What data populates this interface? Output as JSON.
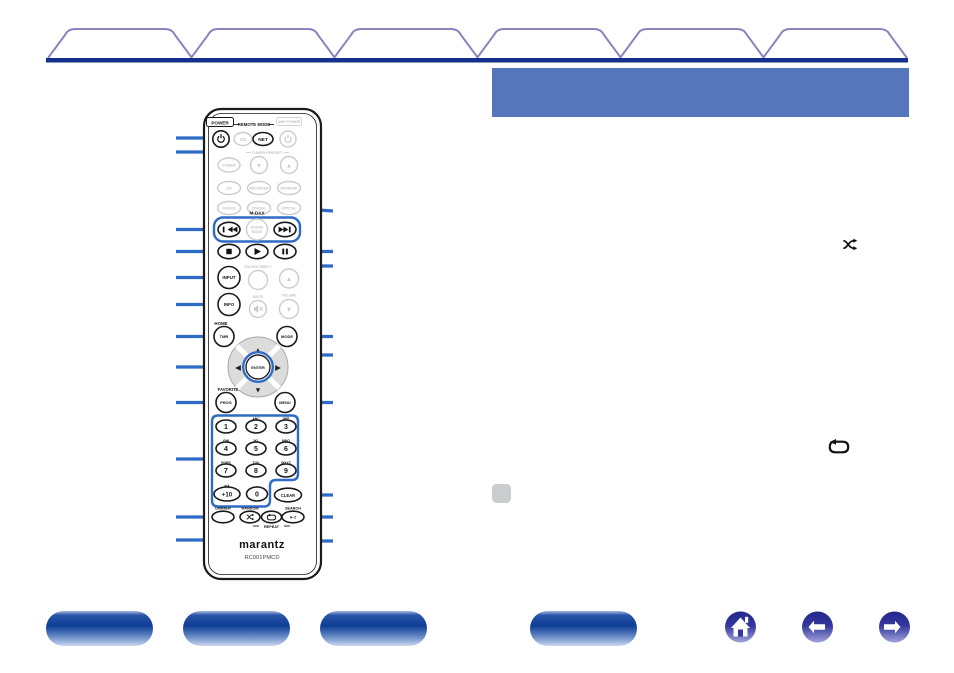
{
  "colors": {
    "callout_blue": "#2e6bc6",
    "header_band": "#5676bb",
    "tab_underline": "#14308c",
    "tab_outline": "#8886bd",
    "pill_blue": "#0d3d96",
    "nav_circle_blue": "#23268b",
    "note_gray": "#c9cdcd"
  },
  "glyphs": {
    "up": "▲",
    "down": "▼",
    "left": "◀",
    "right": "▶"
  },
  "icons": {
    "shuffle": "shuffle-icon",
    "repeat": "repeat-icon",
    "home": "home-icon",
    "back": "back-arrow-icon",
    "forward": "forward-arrow-icon",
    "note": "note-icon",
    "power": "power-icon"
  },
  "tabs": {
    "count": 6
  },
  "remote": {
    "brand": "marantz",
    "model": "RC001PMCD",
    "power_label": "POWER",
    "remote_mode_label": "REMOTE MODE",
    "amp_power_label": "AMP POWER",
    "buttons": {
      "cd_mode": "CD",
      "net_mode": "NET",
      "tuner_preset_label": "TUNER PRESET",
      "tuner": "TUNER",
      "input_cd": "CD",
      "recorder": "RECORDER",
      "network": "NETWORK",
      "phono": "PHONO",
      "coaxial": "COAXIAL",
      "optical": "OPTICAL",
      "mdax_label": "M-DAX",
      "sound_mode_line1": "SOUND",
      "sound_mode_line2": "MODE",
      "input": "INPUT",
      "source_direct_label": "SOURCE DIRECT",
      "info": "INFO",
      "mute_label": "MUTE",
      "volume_label": "VOLUME",
      "home_label": "HOME",
      "timer": "TMR",
      "mode": "MODE",
      "enter": "ENTER",
      "favorite_label": "FAVORITE",
      "prog": "PROG",
      "menu": "MENU",
      "clear": "CLEAR",
      "dimmer_label": "DIMMER",
      "random_label": "RANDOM",
      "search_label": "SEARCH",
      "repeat_label": "REPEAT",
      "search_key": "A–Z",
      "plus10": "+10",
      "plus10_shift": "a/A",
      "zero": "0",
      "zero_shift": "-"
    },
    "keypad": [
      {
        "digit": "1",
        "letters": ".,"
      },
      {
        "digit": "2",
        "letters": "ABC"
      },
      {
        "digit": "3",
        "letters": "DEF"
      },
      {
        "digit": "4",
        "letters": "GHI"
      },
      {
        "digit": "5",
        "letters": "JKL"
      },
      {
        "digit": "6",
        "letters": "MNO"
      },
      {
        "digit": "7",
        "letters": "PQRS"
      },
      {
        "digit": "8",
        "letters": "TUV"
      },
      {
        "digit": "9",
        "letters": "WXYZ"
      }
    ]
  }
}
